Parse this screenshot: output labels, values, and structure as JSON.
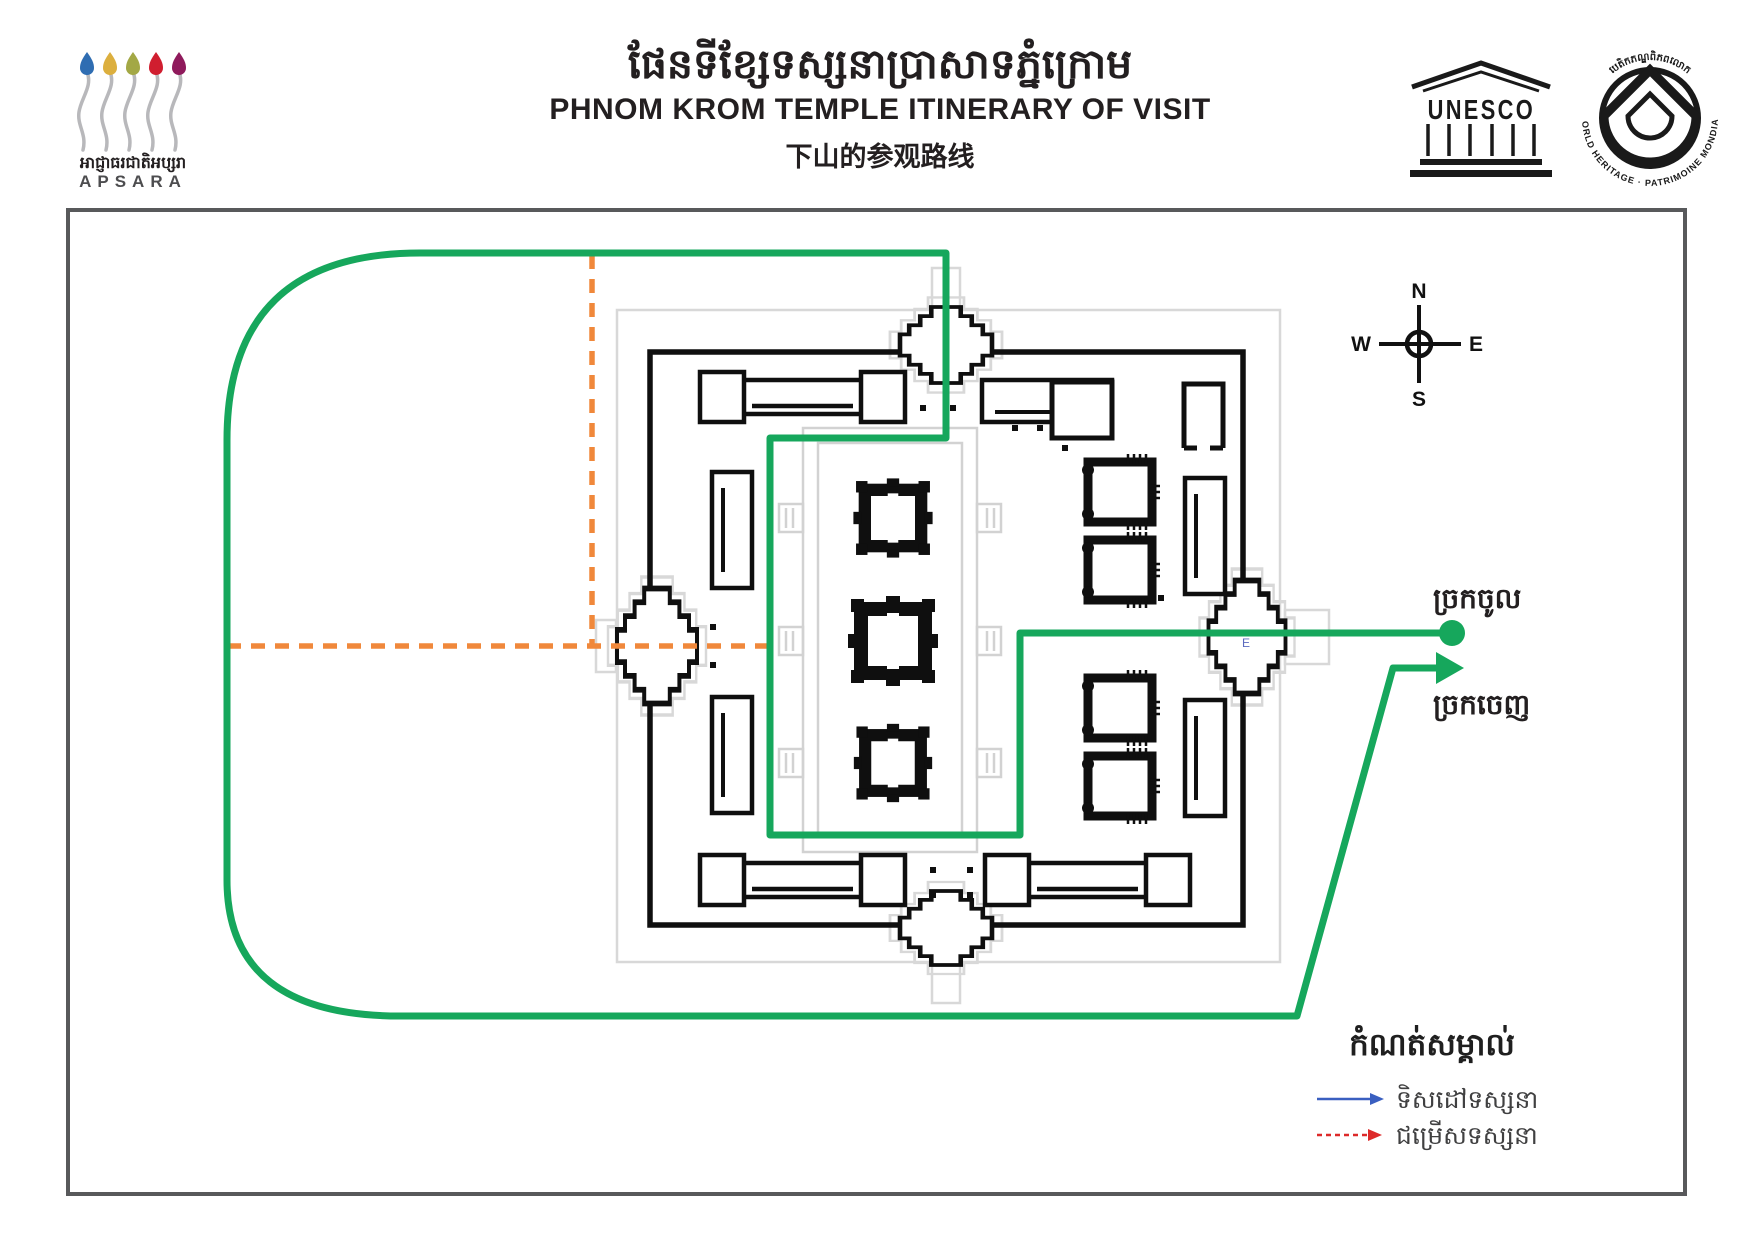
{
  "header": {
    "apsara": {
      "khmer_name": "អាជ្ញាធរជាតិអប្សរា",
      "latin_name": "APSARA"
    },
    "title": {
      "khmer": "ផែនទីខ្សែទស្សនាប្រាសាទភ្នំក្រោម",
      "english": "PHNOM KROM TEMPLE ITINERARY OF VISIT",
      "chinese": "下山的参观路线"
    },
    "unesco_label": "UNESCO",
    "world_heritage": {
      "ring_top_khmer": "បេតិកភណ្ឌពិភពលោក",
      "ring_bottom": "WORLD HERITAGE · PATRIMOINE MONDIAL"
    }
  },
  "map": {
    "compass": {
      "north": "N",
      "east": "E",
      "south": "S",
      "west": "W"
    },
    "entrance_label": "ច្រកចូល",
    "exit_label": "ច្រកចេញ",
    "east_gate_letter": "E"
  },
  "legend": {
    "title": "កំណត់សម្គាល់",
    "items": [
      {
        "label": "ទិសដៅទស្សនា",
        "line_style": "solid",
        "color": "#3a5fc0"
      },
      {
        "label": "ជម្រើសទស្សនា",
        "line_style": "dashed",
        "color": "#dd2a2a"
      }
    ]
  },
  "colors": {
    "route_green": "#16a75c",
    "option_orange": "#f0883b",
    "frame_gray": "#58595b",
    "plan_black": "#0f0f0f",
    "plan_light_gray": "#d8d8d8",
    "text_dark": "#231f20"
  }
}
